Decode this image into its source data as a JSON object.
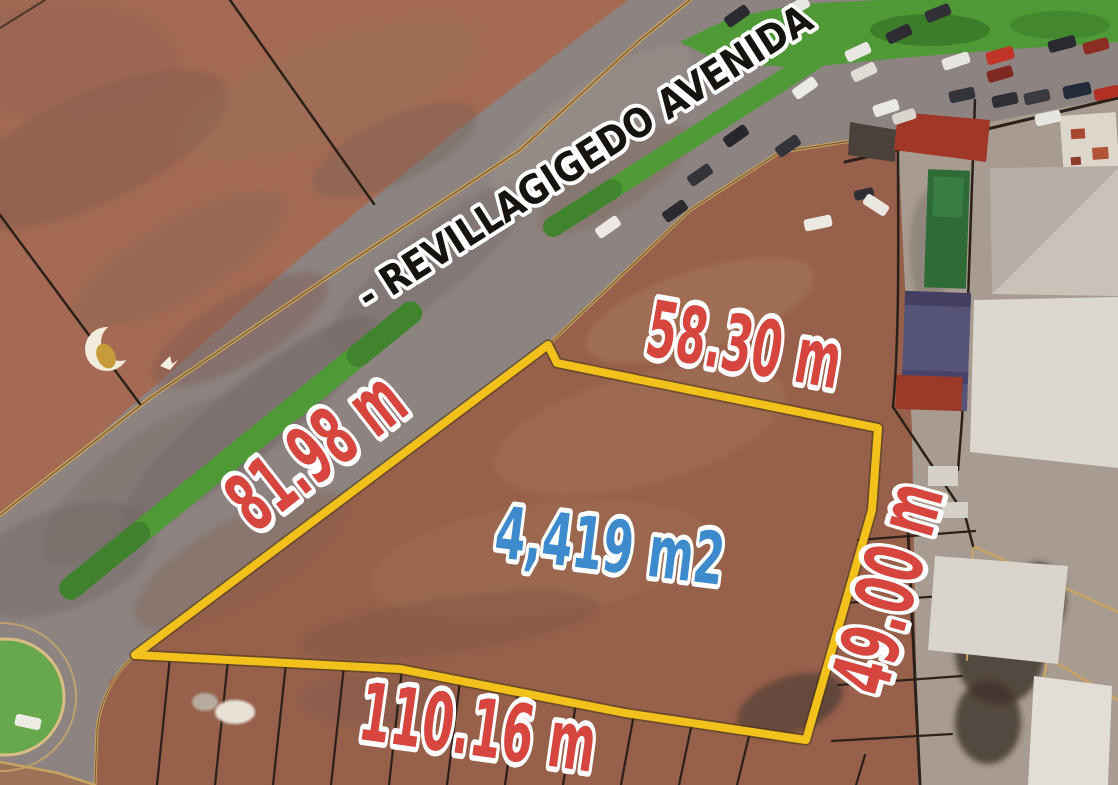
{
  "map": {
    "street": {
      "label": "- REVILLAGIGEDO AVENIDA"
    },
    "parcel": {
      "area_label": "4,419 m2",
      "side_top": "58.30 m",
      "side_left": "81.98 m",
      "side_right": "49.00 m",
      "side_bottom": "110.16 m"
    },
    "colors": {
      "parcel_outline": "#F2C11B",
      "dimension_text": "#D6453E",
      "area_text": "#3D8BCD",
      "street_text": "#17130F",
      "label_stroke": "#FFFFFF",
      "grass": "#4F9937",
      "road": "#8D8380",
      "dirt": "#96604B"
    }
  }
}
